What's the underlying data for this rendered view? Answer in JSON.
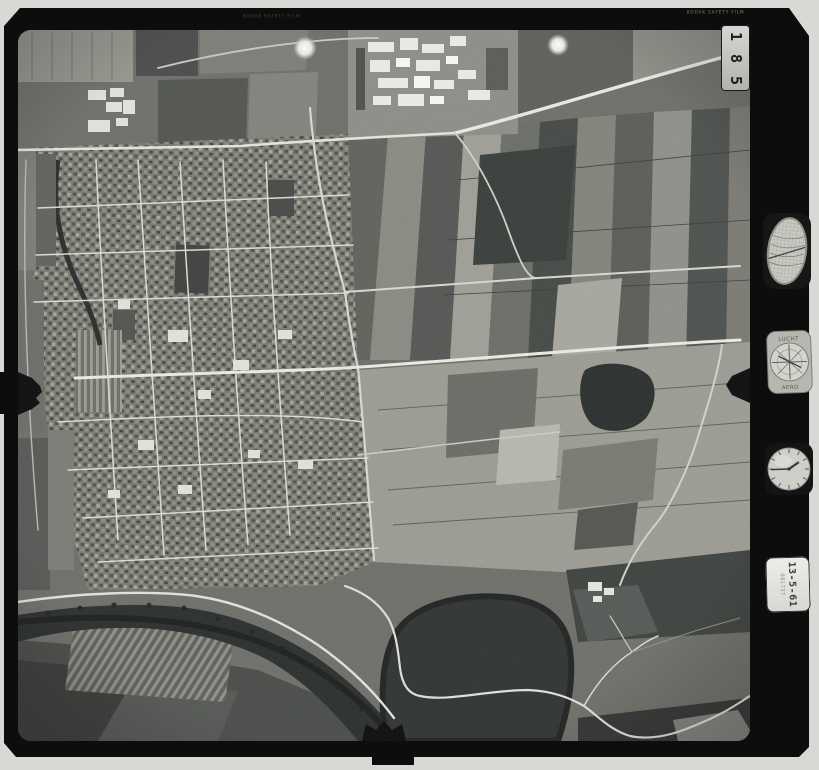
{
  "film": {
    "frame_number": "185",
    "frame_digits": [
      "1",
      "8",
      "5"
    ],
    "edge_print_top_right": "KODAK SAFETY FILM",
    "edge_print_top_left": "KODAK SAFETY FILM"
  },
  "instruments": {
    "altimeter_dial": {
      "top_label": "LUCHT",
      "bottom_label": "AERO"
    },
    "data_card": {
      "date": "13-5-61",
      "code": "881737"
    }
  },
  "photo": {
    "subject": "Vertical aerial photograph of a town with street grid, surrounding farm field patchwork and a dark meandering river with oxbow loop at the bottom"
  }
}
